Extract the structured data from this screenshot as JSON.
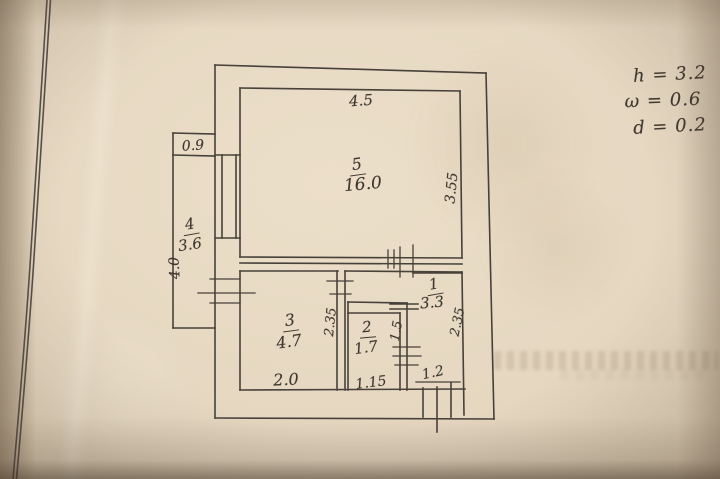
{
  "colors": {
    "paper": "#e6d8c1",
    "ink": "#3e3830",
    "page_border": "#57504a"
  },
  "plan": {
    "rooms": [
      {
        "number": "1",
        "area": "3.3"
      },
      {
        "number": "2",
        "area": "1.7"
      },
      {
        "number": "3",
        "area": "4.7"
      },
      {
        "number": "4",
        "area": "3.6"
      },
      {
        "number": "5",
        "area": "16.0"
      }
    ],
    "dimensions": {
      "room5_width": "4.5",
      "room5_depth": "3.55",
      "balcony_width": "0.9",
      "balcony_length": "4.0",
      "room3_width": "2.0",
      "room3_depth": "2.35",
      "room2_width": "1.15",
      "room2_depth": "1.5",
      "room1_depth": "2.35",
      "entrance_width": "1.2"
    },
    "notes": [
      {
        "text": "h = 3.2"
      },
      {
        "text": "ω = 0.6"
      },
      {
        "text": "d = 0.2"
      }
    ]
  }
}
